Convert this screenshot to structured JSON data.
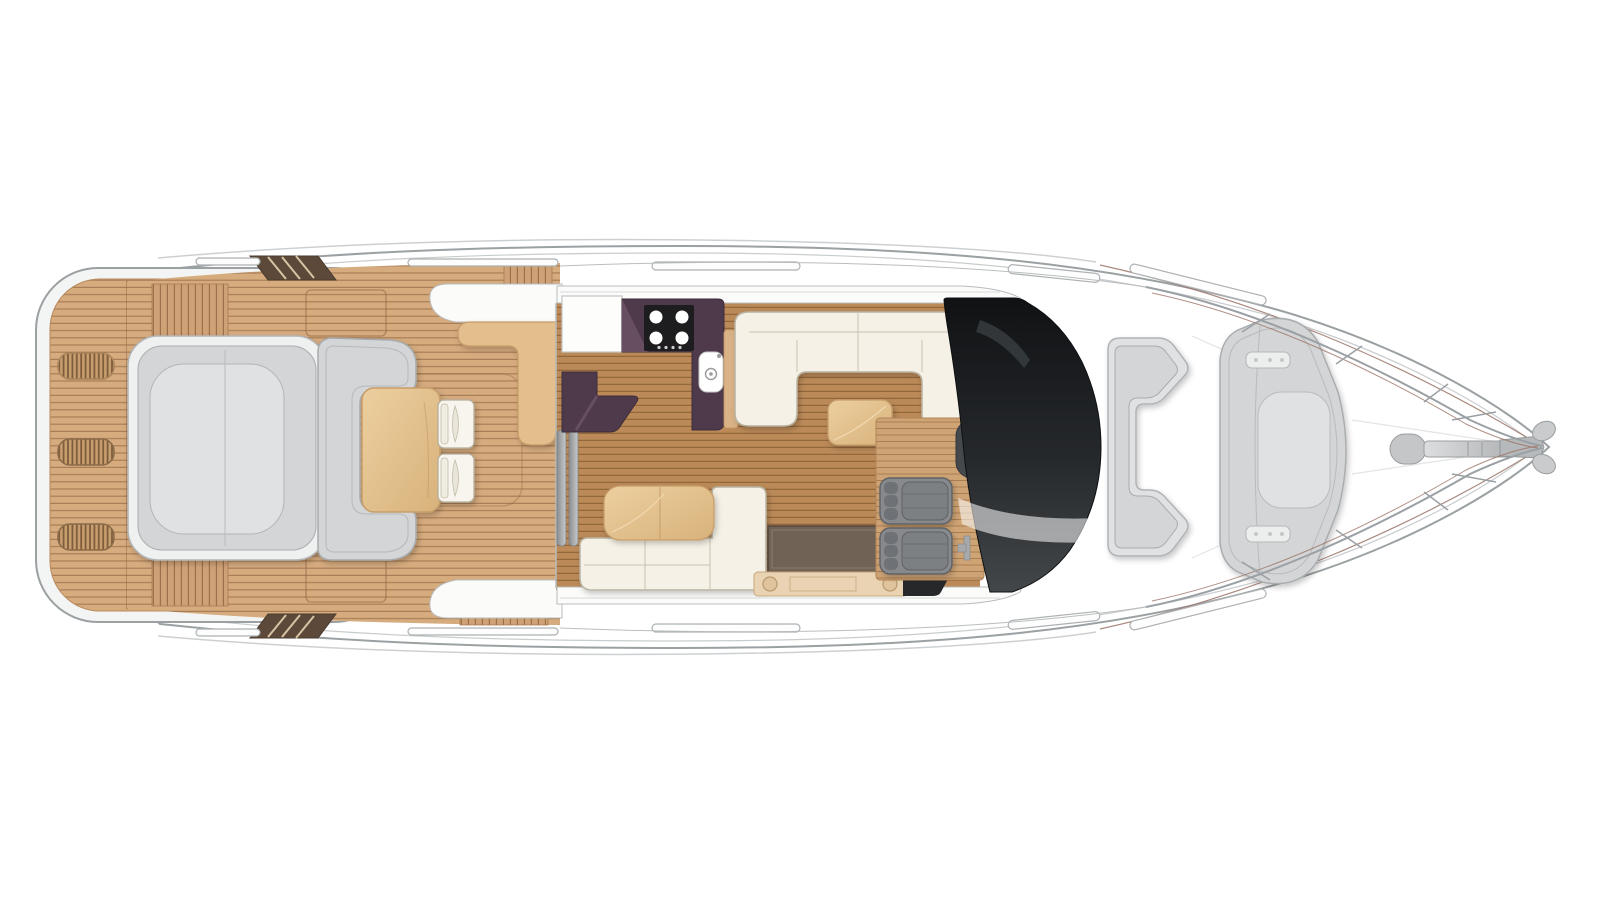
{
  "page": {
    "title": "Motor yacht main deck floor plan",
    "type": "boat-deck-plan-illustration",
    "orientation": "bow facing right, stern facing left",
    "visible_text": []
  },
  "palette": {
    "background": "#ffffff",
    "hull_line": "#9ba0a3",
    "hull_inner_line": "#c9ccce",
    "teak": "#d6ab7e",
    "teak_line": "#7a522f",
    "interior_wood": "#bb8a58",
    "helm_wood": "#cfa475",
    "galley_counter": "#4f3a4b",
    "galley_counter_light": "#6a5164",
    "stove": "#1d1d1f",
    "upholstery_cream": "#f5f1e6",
    "upholstery_stroke": "#b9b3a2",
    "table_tan": "#e4bf8e",
    "table_stroke": "#c79d6a",
    "cushion_gray": "#d3d5d6",
    "cushion_light": "#dfe1e2",
    "cushion_border": "#aaadaf",
    "seat_gray": "#87898c",
    "seat_dark": "#6e7174",
    "sideboard_brown": "#706255",
    "cabinet_tan": "#e9d3b2",
    "windshield_dark": "#17191b",
    "stair_brown": "#5d4939",
    "railing": "#9aa0a3",
    "accent_brown": "#9b7468"
  },
  "regions": {
    "swim_platform": {
      "name": "Swim platform",
      "features": [
        "teak planking",
        "three deck grilles",
        "platform seam"
      ]
    },
    "cockpit": {
      "name": "Aft cockpit",
      "features": [
        "aft sun lounge",
        "C-shaped sofa",
        "teak cockpit table",
        "two folding chairs",
        "wet bar",
        "flybridge stair wedges",
        "side-deck steps",
        "deck hatch outlines"
      ]
    },
    "galley": {
      "name": "Galley",
      "features": [
        "white worktop",
        "dark L-shaped counter with 4-burner hob",
        "sink with tap",
        "lower L-counter",
        "peninsula side panel"
      ]
    },
    "salon": {
      "name": "Main salon",
      "features": [
        "U-shaped cream sofa",
        "coffee table",
        "L-shaped dinette sofa",
        "dinette table",
        "dark sideboard",
        "aft cabinet with speakers",
        "companionway steps"
      ]
    },
    "helm": {
      "name": "Helm station",
      "features": [
        "two helm seats",
        "console",
        "wood platform"
      ]
    },
    "windshield": {
      "name": "Wraparound windscreen",
      "features": [
        "dark tinted glass",
        "reflection highlight"
      ]
    },
    "foredeck": {
      "name": "Foredeck",
      "features": [
        "forward C-seat",
        "bow sunpad",
        "mounting plates",
        "grab-rail capsules",
        "bow railings with stanchions",
        "anchor windlass",
        "anchor"
      ]
    }
  },
  "counts": {
    "deck_grilles": 3,
    "hob_burners": 4,
    "cockpit_chairs": 2,
    "helm_seats": 2,
    "grab_rails_per_side": 5
  }
}
